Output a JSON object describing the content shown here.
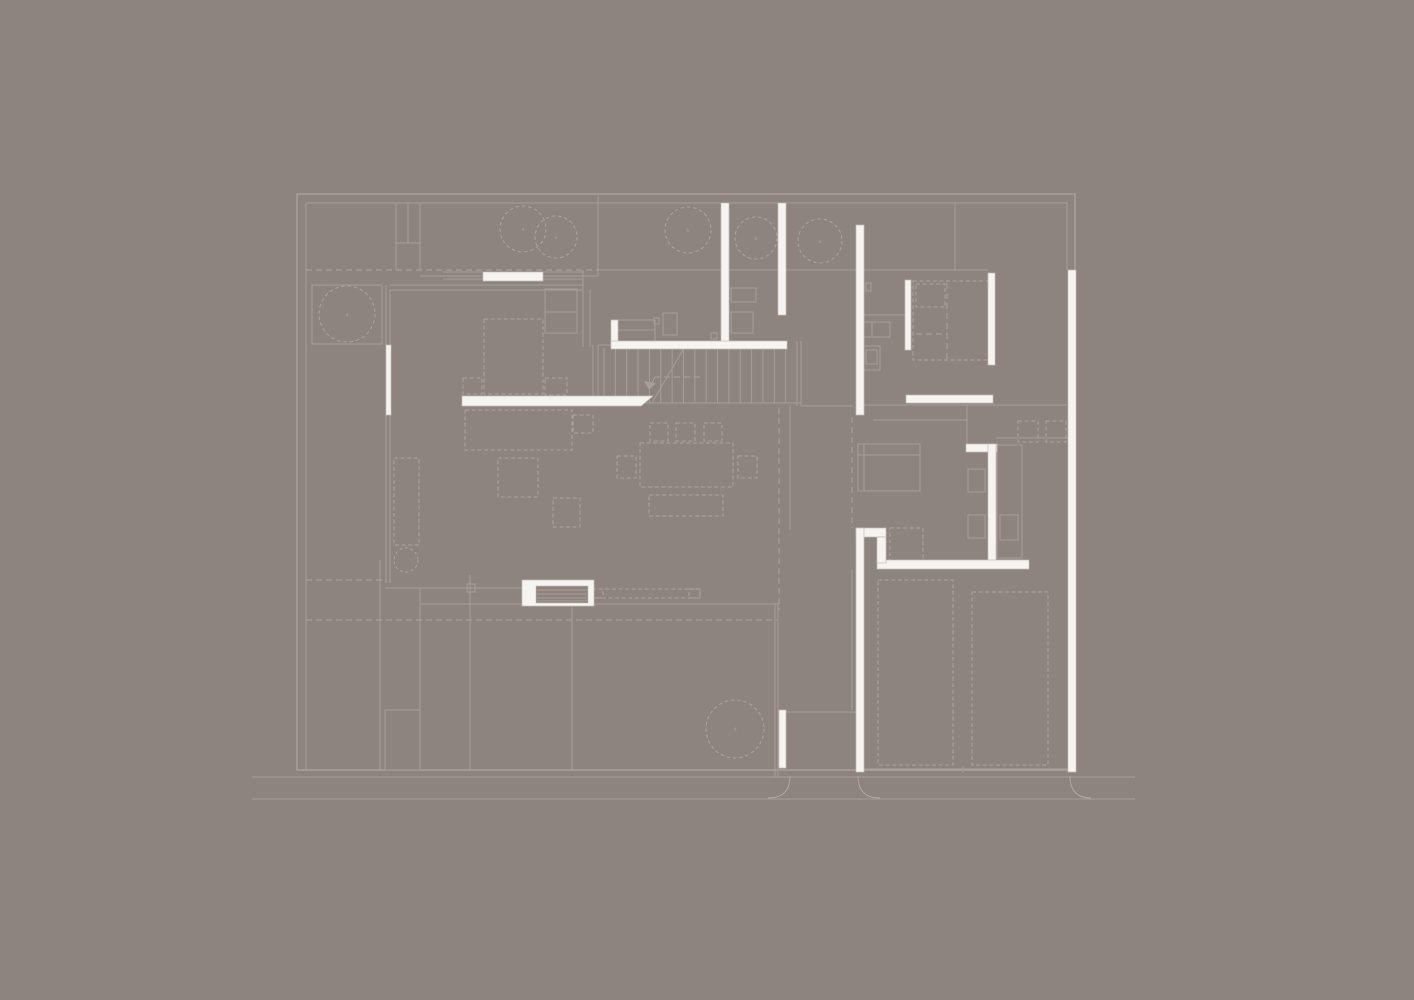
{
  "canvas": {
    "width": 1414,
    "height": 1000,
    "background": "#8d837f",
    "line_color": "#a79e9a",
    "boundary_color": "#b0a7a2",
    "dashed_color": "#ada49f",
    "wall_fill": "#f6f4f1",
    "wall_stroke": "#c7beb8"
  },
  "plan": {
    "boundary_rect": [
      297,
      194,
      778,
      576
    ],
    "solid_lines": [
      [
        306,
        203,
        1067,
        203
      ],
      [
        306,
        203,
        306,
        770
      ],
      [
        1067,
        203,
        1067,
        270
      ],
      [
        252,
        777,
        1135,
        777
      ],
      [
        252,
        799,
        1135,
        799
      ],
      [
        598,
        270,
        988,
        270
      ],
      [
        420,
        276,
        598,
        276
      ],
      [
        598,
        196,
        598,
        276
      ],
      [
        955,
        203,
        955,
        270
      ],
      [
        396,
        203,
        396,
        270
      ],
      [
        420,
        203,
        420,
        270
      ],
      [
        408,
        203,
        408,
        243
      ],
      [
        396,
        243,
        420,
        243
      ],
      [
        390,
        285,
        583,
        285
      ],
      [
        390,
        290,
        583,
        290
      ],
      [
        443,
        272,
        483,
        272
      ],
      [
        443,
        279,
        483,
        279
      ],
      [
        543,
        272,
        583,
        272
      ],
      [
        543,
        279,
        583,
        279
      ],
      [
        386,
        285,
        386,
        583
      ],
      [
        390,
        290,
        390,
        583
      ],
      [
        583,
        270,
        583,
        347
      ],
      [
        590,
        290,
        590,
        347
      ],
      [
        545,
        312,
        577,
        312
      ],
      [
        385,
        588,
        522,
        588
      ],
      [
        420,
        604,
        777,
        604
      ],
      [
        593,
        403,
        801,
        403
      ],
      [
        593,
        345,
        593,
        403
      ],
      [
        598,
        345,
        598,
        403
      ],
      [
        598,
        345,
        611,
        345
      ],
      [
        797,
        341,
        797,
        406
      ],
      [
        801,
        341,
        801,
        406
      ],
      [
        801,
        406,
        853,
        406
      ],
      [
        790,
        405,
        790,
        530
      ],
      [
        785,
        712,
        856,
        712
      ],
      [
        852,
        570,
        852,
        710
      ],
      [
        775,
        603,
        775,
        777
      ],
      [
        778,
        603,
        778,
        777
      ],
      [
        380,
        560,
        380,
        770
      ],
      [
        420,
        588,
        420,
        770
      ],
      [
        470,
        575,
        470,
        770
      ],
      [
        572,
        604,
        572,
        770
      ],
      [
        856,
        315,
        905,
        315
      ],
      [
        864,
        405,
        1067,
        405
      ],
      [
        873,
        420,
        967,
        420
      ],
      [
        967,
        405,
        967,
        444
      ],
      [
        996,
        438,
        1068,
        438
      ],
      [
        864,
        769,
        1068,
        769
      ],
      [
        963,
        766,
        963,
        773
      ],
      [
        858,
        455,
        920,
        455
      ],
      [
        864,
        444,
        864,
        491
      ],
      [
        613,
        330,
        655,
        330
      ],
      [
        872,
        322,
        872,
        337
      ]
    ],
    "solid_rects": [
      [
        312,
        285,
        70,
        59
      ],
      [
        385,
        710,
        35,
        60
      ],
      [
        545,
        289,
        32,
        44
      ],
      [
        613,
        320,
        42,
        23
      ],
      [
        663,
        313,
        14,
        22
      ],
      [
        711,
        333,
        6,
        6
      ],
      [
        654,
        318,
        5,
        6
      ],
      [
        731,
        288,
        25,
        14
      ],
      [
        731,
        312,
        22,
        21
      ],
      [
        863,
        322,
        27,
        15
      ],
      [
        863,
        346,
        17,
        24
      ],
      [
        866,
        350,
        11,
        14
      ],
      [
        866,
        283,
        5,
        8
      ],
      [
        858,
        444,
        62,
        47
      ],
      [
        997,
        445,
        25,
        113
      ],
      [
        968,
        469,
        17,
        23
      ],
      [
        968,
        515,
        17,
        23
      ],
      [
        1000,
        515,
        18,
        25
      ],
      [
        467,
        584,
        8,
        8
      ]
    ],
    "dashed_lines": [
      [
        306,
        270,
        598,
        270
      ],
      [
        306,
        580,
        382,
        580
      ],
      [
        306,
        620,
        777,
        620
      ],
      [
        779,
        408,
        779,
        610
      ],
      [
        852,
        417,
        852,
        528
      ],
      [
        700,
        377,
        655,
        377
      ],
      [
        655,
        377,
        649,
        389
      ],
      [
        947,
        283,
        947,
        359
      ],
      [
        916,
        334,
        947,
        334
      ]
    ],
    "dashed_rects": [
      [
        484,
        319,
        59,
        75
      ],
      [
        463,
        378,
        19,
        16
      ],
      [
        545,
        378,
        22,
        17
      ],
      [
        465,
        410,
        107,
        40
      ],
      [
        573,
        415,
        20,
        18
      ],
      [
        498,
        458,
        40,
        39
      ],
      [
        553,
        498,
        27,
        29
      ],
      [
        394,
        458,
        25,
        87
      ],
      [
        640,
        443,
        93,
        44
      ],
      [
        650,
        423,
        18,
        18
      ],
      [
        676,
        423,
        19,
        18
      ],
      [
        704,
        423,
        18,
        18
      ],
      [
        617,
        456,
        19,
        22
      ],
      [
        738,
        456,
        19,
        22
      ],
      [
        649,
        495,
        74,
        21
      ],
      [
        592,
        589,
        108,
        9
      ],
      [
        592,
        589,
        11,
        9
      ],
      [
        689,
        589,
        11,
        9
      ],
      [
        913,
        281,
        77,
        79
      ],
      [
        916,
        284,
        29,
        23
      ],
      [
        890,
        528,
        33,
        34
      ],
      [
        878,
        580,
        75,
        185
      ],
      [
        972,
        592,
        76,
        173
      ],
      [
        1018,
        421,
        20,
        21
      ],
      [
        1046,
        421,
        20,
        21
      ]
    ],
    "trees": [
      {
        "cx": 523,
        "cy": 229,
        "r": 23,
        "label": "a"
      },
      {
        "cx": 556,
        "cy": 237,
        "r": 21,
        "label": "a"
      },
      {
        "cx": 688,
        "cy": 230,
        "r": 23,
        "label": "b"
      },
      {
        "cx": 756,
        "cy": 238,
        "r": 21,
        "label": "b"
      },
      {
        "cx": 820,
        "cy": 241,
        "r": 22,
        "label": "a"
      },
      {
        "cx": 347,
        "cy": 314,
        "r": 28,
        "label": "a"
      },
      {
        "cx": 735,
        "cy": 729,
        "r": 29,
        "label": "d"
      }
    ],
    "sink_circle": {
      "cx": 406,
      "cy": 560,
      "r": 12
    },
    "stairs": {
      "x1": 604,
      "x2": 797,
      "count": 18,
      "y1": 348,
      "y2": 403,
      "diagonal": [
        684,
        348,
        652,
        403
      ]
    },
    "stair_arrow_head": [
      [
        649,
        390
      ],
      [
        656,
        383
      ],
      [
        644,
        381
      ]
    ],
    "walls": [
      [
        721,
        203,
        8,
        144
      ],
      [
        778,
        203,
        8,
        112
      ],
      [
        856,
        225,
        8,
        190
      ],
      [
        483,
        272,
        60,
        9
      ],
      [
        611,
        320,
        7,
        28
      ],
      [
        611,
        341,
        176,
        8
      ],
      [
        386,
        345,
        5,
        70
      ],
      [
        905,
        280,
        6,
        70
      ],
      [
        988,
        273,
        7,
        92
      ],
      [
        906,
        395,
        87,
        8
      ],
      [
        966,
        444,
        31,
        8
      ],
      [
        988,
        444,
        8,
        124
      ],
      [
        877,
        560,
        152,
        9
      ],
      [
        856,
        528,
        30,
        9
      ],
      [
        877,
        537,
        9,
        26
      ],
      [
        856,
        528,
        8,
        244
      ],
      [
        1068,
        270,
        8,
        502
      ],
      [
        779,
        710,
        7,
        58
      ],
      [
        522,
        580,
        72,
        26
      ]
    ],
    "wall_polygons": [
      [
        [
          462,
          396
        ],
        [
          653,
          396
        ],
        [
          641,
          406
        ],
        [
          462,
          406
        ]
      ]
    ],
    "steps_block": {
      "inner": [
        536,
        586,
        52,
        17
      ],
      "lines_y": [
        590,
        594,
        598,
        601
      ],
      "x1": 537,
      "x2": 587
    },
    "driveway_arcs": [
      "M790,776 Q790,798 768,798",
      "M858,776 Q858,798 880,798",
      "M1070,776 Q1070,798 1091,798"
    ]
  }
}
